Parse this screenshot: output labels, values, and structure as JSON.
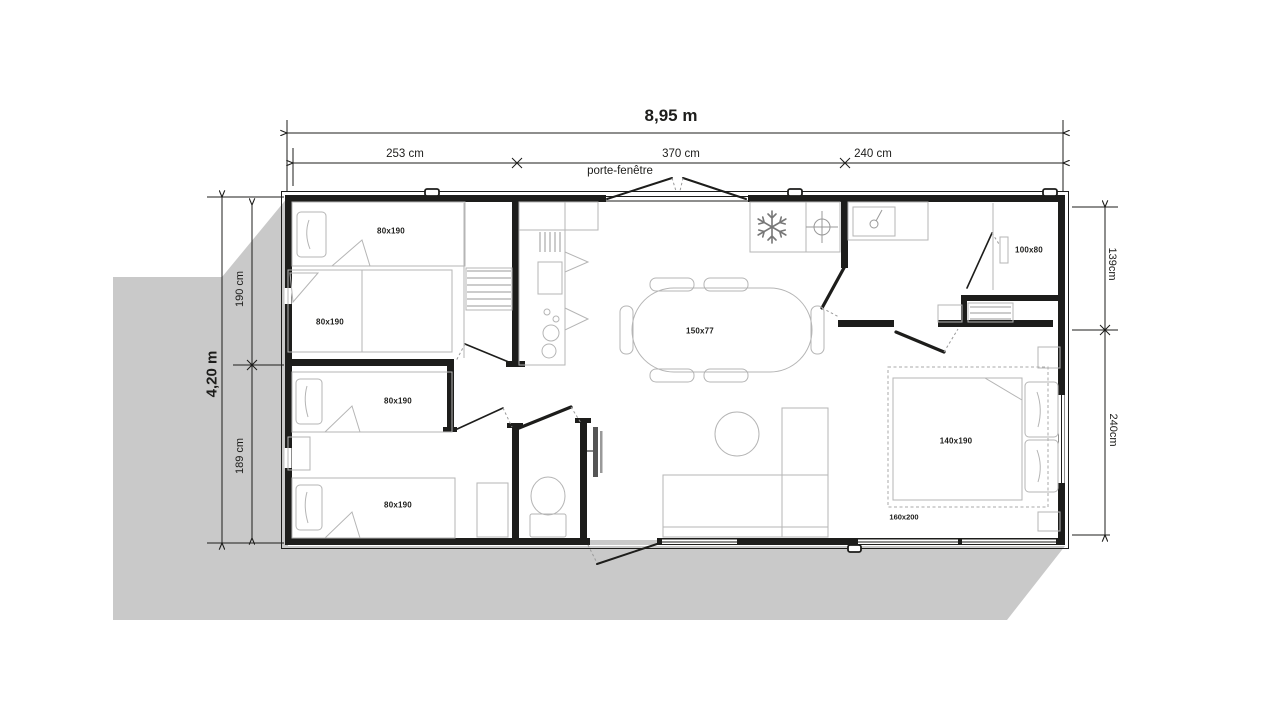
{
  "dimensions": {
    "overall_width": "8,95 m",
    "overall_depth": "4,20 m",
    "top_segments": [
      "253 cm",
      "370 cm",
      "240 cm"
    ],
    "left_segments": [
      "190 cm",
      "189 cm"
    ],
    "right_segments": [
      "139cm",
      "240cm"
    ],
    "door_label": "porte-fenêtre"
  },
  "furniture_labels": {
    "bed_top_left_1": "80x190",
    "bed_top_left_2": "80x190",
    "bed_bottom_left_1": "80x190",
    "bed_bottom_left_2": "80x190",
    "dining_table": "150x77",
    "shower": "100x80",
    "double_bed": "140x190",
    "double_bed_base": "160x200"
  },
  "icons": {
    "fridge": "snowflake-icon",
    "water_heater": "crosshair-icon",
    "washbasin": "tap-icon",
    "tv": "tv-screen"
  },
  "colors": {
    "background": "#ffffff",
    "shadow": "#c9c9c9",
    "wall": "#1d1d1b",
    "furniture_line": "#b5b5b5",
    "text": "#1d1d1b"
  }
}
